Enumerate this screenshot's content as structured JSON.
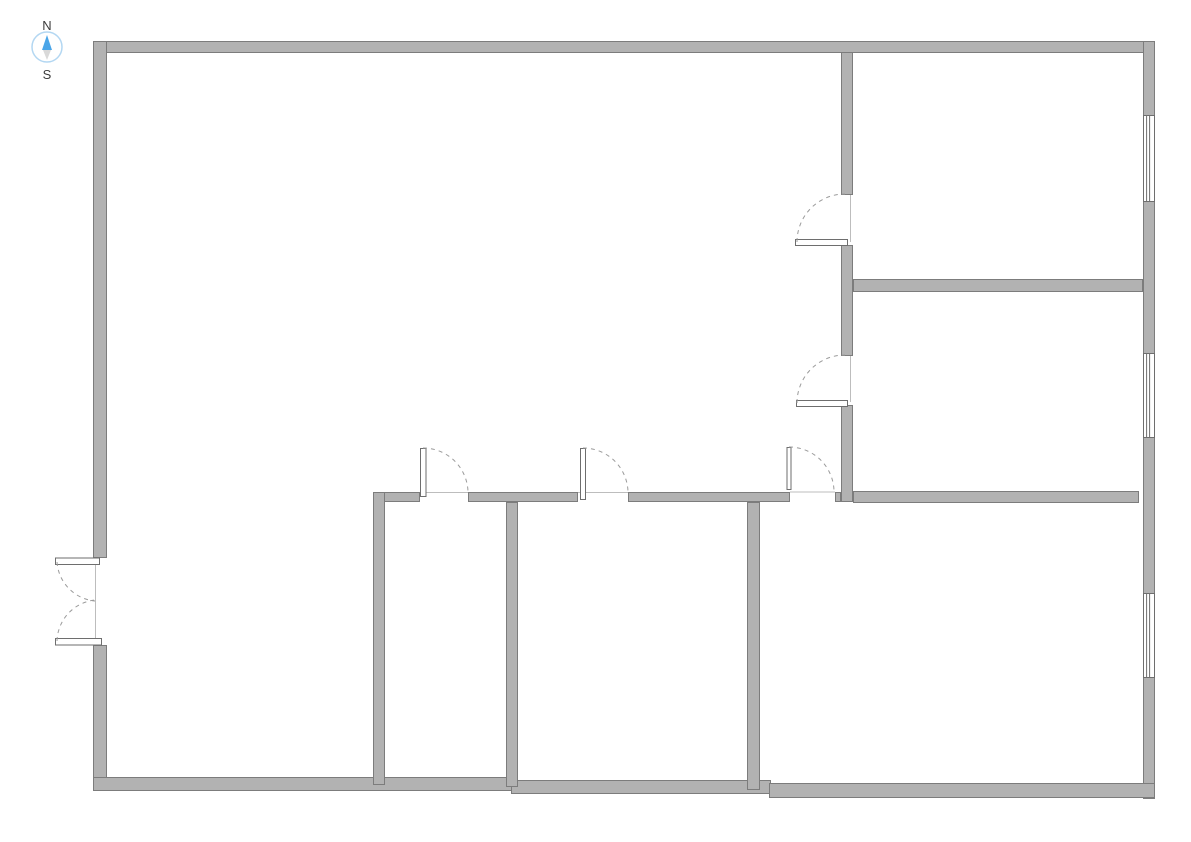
{
  "compass": {
    "north_label": "N",
    "south_label": "S",
    "circle_color": "#b3d7f2",
    "north_needle_color": "#4aa5e8",
    "south_needle_color": "#d9d9d9",
    "label_color": "#3c3c3c"
  },
  "plan": {
    "canvas": {
      "width": 1191,
      "height": 842,
      "background": "#ffffff"
    },
    "style": {
      "wall_fill": "#b2b2b2",
      "wall_stroke": "#7c7c7c",
      "door_leaf_fill": "#ffffff",
      "door_leaf_stroke": "#6e6e6e",
      "swing_arc_color": "#9b9b9b",
      "threshold_color": "#bdbdbd",
      "window_line_color": "#6e6e6e",
      "window_fill": "#ffffff"
    },
    "walls": [
      {
        "name": "outer-wall-top",
        "x": 93,
        "y": 41,
        "w": 1062,
        "h": 12
      },
      {
        "name": "outer-wall-left-upper",
        "x": 93,
        "y": 41,
        "w": 14,
        "h": 517
      },
      {
        "name": "outer-wall-left-lower",
        "x": 93,
        "y": 645,
        "w": 14,
        "h": 146
      },
      {
        "name": "outer-wall-right",
        "x": 1143,
        "y": 41,
        "w": 12,
        "h": 758
      },
      {
        "name": "outer-wall-bottom-west",
        "x": 93,
        "y": 777,
        "w": 420,
        "h": 14
      },
      {
        "name": "outer-wall-bottom-center",
        "x": 511,
        "y": 780,
        "w": 260,
        "h": 14
      },
      {
        "name": "outer-wall-bottom-east",
        "x": 769,
        "y": 783,
        "w": 386,
        "h": 15
      },
      {
        "name": "corridor-wall-upper",
        "x": 841,
        "y": 52,
        "w": 12,
        "h": 143
      },
      {
        "name": "corridor-wall-middle",
        "x": 841,
        "y": 245,
        "w": 12,
        "h": 111
      },
      {
        "name": "corridor-wall-lower",
        "x": 841,
        "y": 405,
        "w": 12,
        "h": 97
      },
      {
        "name": "east-rooms-divider-wall",
        "x": 853,
        "y": 279,
        "w": 290,
        "h": 13
      },
      {
        "name": "south-rooms-wall-a",
        "x": 373,
        "y": 492,
        "w": 47,
        "h": 10
      },
      {
        "name": "south-rooms-wall-b",
        "x": 468,
        "y": 492,
        "w": 110,
        "h": 10
      },
      {
        "name": "south-rooms-wall-c",
        "x": 628,
        "y": 492,
        "w": 162,
        "h": 10
      },
      {
        "name": "south-rooms-wall-d",
        "x": 835,
        "y": 492,
        "w": 6,
        "h": 10
      },
      {
        "name": "south-rooms-wall-east",
        "x": 853,
        "y": 491,
        "w": 286,
        "h": 12
      },
      {
        "name": "small-room-wall-west",
        "x": 373,
        "y": 492,
        "w": 12,
        "h": 293
      },
      {
        "name": "small-room-divider-wall",
        "x": 506,
        "y": 502,
        "w": 12,
        "h": 285
      },
      {
        "name": "southeast-room-wall-west",
        "x": 747,
        "y": 502,
        "w": 13,
        "h": 288
      }
    ],
    "windows": [
      {
        "name": "window-northeast-room",
        "x": 1143,
        "y": 115,
        "w": 12,
        "h": 87
      },
      {
        "name": "window-east-room",
        "x": 1143,
        "y": 353,
        "w": 12,
        "h": 85
      },
      {
        "name": "window-southeast-room",
        "x": 1143,
        "y": 593,
        "w": 12,
        "h": 85
      }
    ],
    "door_leaves": [
      {
        "name": "door-leaf-corridor-upper",
        "x": 795,
        "y": 239,
        "w": 53,
        "h": 7
      },
      {
        "name": "door-leaf-corridor-lower",
        "x": 796,
        "y": 400,
        "w": 52,
        "h": 7
      },
      {
        "name": "door-leaf-room-a",
        "x": 420,
        "y": 448,
        "w": 6.5,
        "h": 49
      },
      {
        "name": "door-leaf-room-b",
        "x": 580,
        "y": 448,
        "w": 6,
        "h": 52
      },
      {
        "name": "door-leaf-room-c",
        "x": 786.5,
        "y": 447,
        "w": 5,
        "h": 43
      },
      {
        "name": "entry-door-leaf-top",
        "x": 55,
        "y": 557.5,
        "w": 45,
        "h": 7.5
      },
      {
        "name": "entry-door-leaf-bottom",
        "x": 55,
        "y": 638,
        "w": 47,
        "h": 7.5
      }
    ],
    "door_swings": [
      {
        "name": "door-swing-corridor-upper",
        "x1": 797,
        "y1": 242,
        "x2": 845,
        "y2": 194,
        "r": 48,
        "sweep": 1
      },
      {
        "name": "door-swing-corridor-lower",
        "x1": 797,
        "y1": 403,
        "x2": 845,
        "y2": 355,
        "r": 48,
        "sweep": 1
      },
      {
        "name": "door-swing-room-a",
        "x1": 423,
        "y1": 448,
        "x2": 468,
        "y2": 492,
        "r": 45,
        "sweep": 1
      },
      {
        "name": "door-swing-room-b",
        "x1": 583,
        "y1": 448,
        "x2": 628,
        "y2": 492,
        "r": 45,
        "sweep": 1
      },
      {
        "name": "door-swing-room-c",
        "x1": 789,
        "y1": 447,
        "x2": 834,
        "y2": 491,
        "r": 45,
        "sweep": 1
      },
      {
        "name": "entry-door-swing-top",
        "x1": 57,
        "y1": 562,
        "x2": 95,
        "y2": 601,
        "r": 42,
        "sweep": 0
      },
      {
        "name": "entry-door-swing-bottom",
        "x1": 57,
        "y1": 641,
        "x2": 95,
        "y2": 600,
        "r": 42.5,
        "sweep": 1
      }
    ],
    "thresholds": [
      {
        "name": "threshold-corridor-upper",
        "x1": 850.5,
        "y1": 195,
        "x2": 850.5,
        "y2": 242
      },
      {
        "name": "threshold-corridor-lower",
        "x1": 850.5,
        "y1": 356,
        "x2": 850.5,
        "y2": 402
      },
      {
        "name": "threshold-room-a",
        "x1": 420,
        "y1": 492.5,
        "x2": 468,
        "y2": 492.5
      },
      {
        "name": "threshold-room-b",
        "x1": 578,
        "y1": 492.5,
        "x2": 628,
        "y2": 492.5
      },
      {
        "name": "threshold-room-c",
        "x1": 790,
        "y1": 492,
        "x2": 835,
        "y2": 492
      },
      {
        "name": "threshold-entry-door",
        "x1": 95.5,
        "y1": 558,
        "x2": 95.5,
        "y2": 643
      }
    ]
  }
}
